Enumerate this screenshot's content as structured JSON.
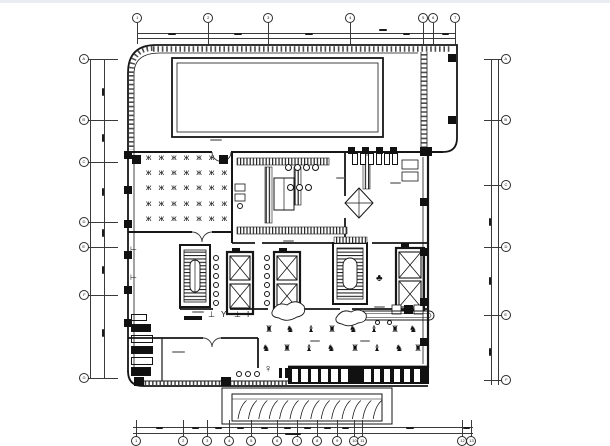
{
  "meta": {
    "type": "architectural floor plan drawing",
    "background": "#ffffff",
    "ink": "#161616",
    "top_strip": "#e9edf1",
    "notes": "CAD ground-floor plan: rooftop pool hall (top), dining room with table grid (left), kitchen core (center), twin stair/elevator cores, gym with equipment rows, south curtain-wall mullions and exterior entry steps (bottom); dimension strings and room labels are sub-pixel illegible and rendered as tick smudges"
  },
  "grid": {
    "axes": [
      {
        "id": "top",
        "dir": "h",
        "line1": 33,
        "line2": 37.5,
        "from": 137,
        "to": 455,
        "stub_from": 23,
        "stub_len": 21,
        "bubble_at": 18,
        "bubbles": [
          [
            137,
            "1"
          ],
          [
            208,
            "2"
          ],
          [
            268,
            "3"
          ],
          [
            350,
            "4"
          ],
          [
            423,
            "5"
          ],
          [
            433,
            "6"
          ],
          [
            455,
            "7"
          ]
        ]
      },
      {
        "id": "bottom",
        "dir": "h",
        "line1": 427,
        "line2": 432.5,
        "from": 133,
        "to": 473,
        "stub_from": 420,
        "stub_len": 18,
        "bubble_at": 441,
        "bubbles": [
          [
            136,
            "1"
          ],
          [
            183,
            "2"
          ],
          [
            207,
            "3"
          ],
          [
            229,
            "4"
          ],
          [
            251,
            "5"
          ],
          [
            277,
            "6"
          ],
          [
            297,
            "7"
          ],
          [
            317,
            "8"
          ],
          [
            337,
            "9"
          ],
          [
            354,
            "10"
          ],
          [
            362,
            "11"
          ],
          [
            462,
            "12"
          ],
          [
            471,
            "13"
          ]
        ]
      },
      {
        "id": "left",
        "dir": "v",
        "line1": 90,
        "line2": 104,
        "from": 59,
        "to": 378,
        "stub_from": 86,
        "stub_len": 32,
        "bubble_at": 84,
        "bubbles": [
          [
            59,
            "A"
          ],
          [
            120,
            "B"
          ],
          [
            162,
            "C"
          ],
          [
            222,
            "D"
          ],
          [
            247,
            "E"
          ],
          [
            295,
            "F"
          ],
          [
            378,
            "G"
          ]
        ]
      },
      {
        "id": "right",
        "dir": "v",
        "line1": 491,
        "line2": 498,
        "from": 59,
        "to": 385,
        "stub_from": 484,
        "stub_len": 22,
        "bubble_at": 506,
        "bubbles": [
          [
            59,
            "A"
          ],
          [
            120,
            "B"
          ],
          [
            185,
            "C"
          ],
          [
            247,
            "D"
          ],
          [
            315,
            "E"
          ],
          [
            380,
            "F"
          ]
        ]
      }
    ],
    "dim_marks": [
      [
        172,
        34,
        "h",
        8
      ],
      [
        238,
        34,
        "h",
        8
      ],
      [
        309,
        34,
        "h",
        8
      ],
      [
        383,
        30,
        "h",
        8
      ],
      [
        406,
        34,
        "h",
        7
      ],
      [
        445,
        34,
        "h",
        7
      ],
      [
        159,
        428,
        "h",
        7
      ],
      [
        195,
        428,
        "h",
        7
      ],
      [
        218,
        428,
        "h",
        7
      ],
      [
        240,
        428,
        "h",
        7
      ],
      [
        264,
        428,
        "h",
        7
      ],
      [
        287,
        428,
        "h",
        7
      ],
      [
        307,
        428,
        "h",
        7
      ],
      [
        327,
        428,
        "h",
        7
      ],
      [
        345,
        428,
        "h",
        7
      ],
      [
        410,
        428,
        "h",
        8
      ],
      [
        466,
        428,
        "h",
        7
      ],
      [
        293,
        433.5,
        "h",
        16
      ],
      [
        103,
        92,
        "v",
        8
      ],
      [
        103,
        138,
        "v",
        8
      ],
      [
        103,
        192,
        "v",
        8
      ],
      [
        103,
        233,
        "v",
        8
      ],
      [
        103,
        270,
        "v",
        8
      ],
      [
        103,
        333,
        "v",
        8
      ],
      [
        490,
        222,
        "v",
        8
      ],
      [
        490,
        281,
        "v",
        8
      ],
      [
        490,
        352,
        "v",
        8
      ]
    ]
  },
  "plan": {
    "bars": [
      [
        124,
        151,
        8,
        8
      ],
      [
        124,
        186,
        8,
        8
      ],
      [
        124,
        220,
        8,
        8
      ],
      [
        124,
        251,
        8,
        8
      ],
      [
        124,
        286,
        8,
        8
      ],
      [
        124,
        319,
        8,
        8
      ],
      [
        132,
        155,
        9,
        9
      ],
      [
        219,
        155,
        9,
        9
      ],
      [
        134,
        377,
        10,
        9
      ],
      [
        221,
        377,
        10,
        9
      ],
      [
        420,
        147,
        12,
        9
      ],
      [
        420,
        198,
        8,
        8
      ],
      [
        420,
        248,
        8,
        8
      ],
      [
        420,
        298,
        8,
        8
      ],
      [
        420,
        338,
        8,
        8
      ],
      [
        448,
        54,
        8,
        8
      ],
      [
        448,
        116,
        8,
        8
      ],
      [
        348,
        147,
        7,
        7
      ],
      [
        362,
        147,
        7,
        7
      ],
      [
        376,
        147,
        7,
        7
      ],
      [
        390,
        147,
        7,
        7
      ],
      [
        184,
        316,
        18,
        4
      ],
      [
        279,
        368,
        3,
        10
      ],
      [
        285,
        368,
        3,
        10
      ],
      [
        294,
        371,
        7,
        7
      ],
      [
        404,
        305,
        9,
        9
      ],
      [
        232,
        248,
        8,
        4
      ],
      [
        279,
        248,
        8,
        4
      ],
      [
        401,
        243,
        8,
        4
      ]
    ],
    "circles": [
      [
        213,
        255,
        6
      ],
      [
        213,
        264,
        6
      ],
      [
        213,
        273,
        6
      ],
      [
        213,
        282,
        6
      ],
      [
        213,
        291,
        6
      ],
      [
        213,
        300,
        6
      ],
      [
        264,
        255,
        6
      ],
      [
        264,
        264,
        6
      ],
      [
        264,
        273,
        6
      ],
      [
        264,
        282,
        6
      ],
      [
        264,
        291,
        6
      ],
      [
        264,
        300,
        6
      ],
      [
        285,
        164,
        7
      ],
      [
        294,
        164,
        7
      ],
      [
        303,
        164,
        7
      ],
      [
        312,
        164,
        7
      ],
      [
        287,
        184,
        7
      ],
      [
        296,
        184,
        7
      ],
      [
        305,
        184,
        7
      ],
      [
        375,
        320,
        5
      ],
      [
        387,
        320,
        5
      ],
      [
        236,
        371,
        6
      ],
      [
        245,
        371,
        6
      ],
      [
        254,
        371,
        6
      ],
      [
        237,
        203,
        6
      ]
    ],
    "glyphs": [
      [
        265,
        325,
        "♜",
        9
      ],
      [
        286,
        325,
        "♞",
        9
      ],
      [
        307,
        325,
        "♝",
        9
      ],
      [
        328,
        325,
        "♜",
        9
      ],
      [
        349,
        325,
        "♞",
        9
      ],
      [
        370,
        325,
        "♝",
        9
      ],
      [
        391,
        325,
        "♜",
        9
      ],
      [
        409,
        325,
        "♞",
        9
      ],
      [
        262,
        344,
        "♞",
        9
      ],
      [
        283,
        344,
        "♜",
        9
      ],
      [
        305,
        344,
        "♝",
        9
      ],
      [
        327,
        344,
        "♞",
        9
      ],
      [
        351,
        344,
        "♜",
        9
      ],
      [
        373,
        344,
        "♝",
        9
      ],
      [
        395,
        344,
        "♞",
        9
      ],
      [
        414,
        344,
        "♜",
        9
      ],
      [
        208,
        311,
        "⊥",
        8
      ],
      [
        221,
        311,
        "Y",
        8
      ],
      [
        234,
        311,
        "⊥",
        8
      ],
      [
        247,
        311,
        "I",
        8
      ],
      [
        376,
        274,
        "♣",
        10
      ],
      [
        264,
        364,
        "♀",
        11
      ],
      [
        130,
        246,
        "⊢",
        8
      ],
      [
        130,
        274,
        "⊢",
        8
      ]
    ],
    "dining": {
      "x0": 146,
      "y0": 154,
      "dx": 12.6,
      "dy": 15.2,
      "cols": 7,
      "rows": 5,
      "glyph": "ж",
      "size": 8
    },
    "lockers": [
      [
        131,
        314,
        16,
        7,
        0
      ],
      [
        131,
        324,
        20,
        8,
        1
      ],
      [
        131,
        335,
        22,
        8,
        0
      ],
      [
        131,
        346,
        22,
        8,
        1
      ],
      [
        131,
        357,
        22,
        8,
        0
      ],
      [
        131,
        367,
        20,
        9,
        1
      ]
    ],
    "stalls": {
      "x0": 352,
      "y": 153,
      "n": 6,
      "dx": 8,
      "w": 6,
      "h": 12
    },
    "mullions": {
      "bar": [
        288,
        366,
        141,
        18
      ],
      "cell_y": 368.5,
      "cell_h": 13,
      "cell_w": 6.5,
      "groups": [
        {
          "x0": 291.5,
          "n": 6,
          "dx": 9.9
        },
        {
          "x0": 364,
          "n": 6,
          "dx": 9.9
        }
      ]
    },
    "treads": {
      "x0": 238,
      "n": 14,
      "dx": 10.4
    },
    "room_label_marks": [
      [
        210,
        139,
        12
      ],
      [
        390,
        182,
        11
      ],
      [
        283,
        240,
        11
      ],
      [
        192,
        311,
        12
      ],
      [
        374,
        306,
        11
      ],
      [
        172,
        351,
        13
      ],
      [
        310,
        340,
        10
      ],
      [
        360,
        340,
        10
      ],
      [
        336,
        177,
        9
      ]
    ]
  }
}
